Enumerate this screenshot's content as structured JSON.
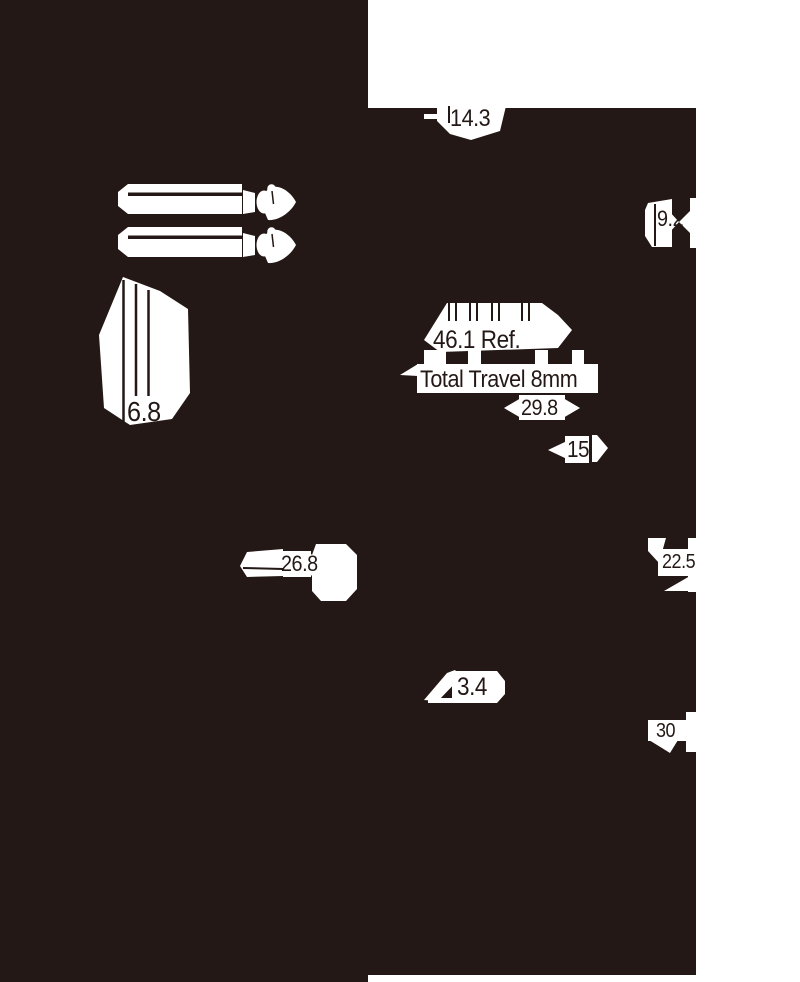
{
  "drawing": {
    "title": "slide-potentiometer-dimension-drawing",
    "colors": {
      "ink": "#231815",
      "paper": "#ffffff"
    },
    "dims": {
      "top_offset": "14.3",
      "lever_pitch": "9.2",
      "body_thickness": "6.8",
      "ref_length": "46.1 Ref.",
      "travel": "Total Travel 8mm",
      "mount_pitch": "29.8",
      "stroke": "15",
      "body_width": "26.8",
      "height": "22.5",
      "pin_offset": "3.4",
      "depth": "30"
    }
  }
}
